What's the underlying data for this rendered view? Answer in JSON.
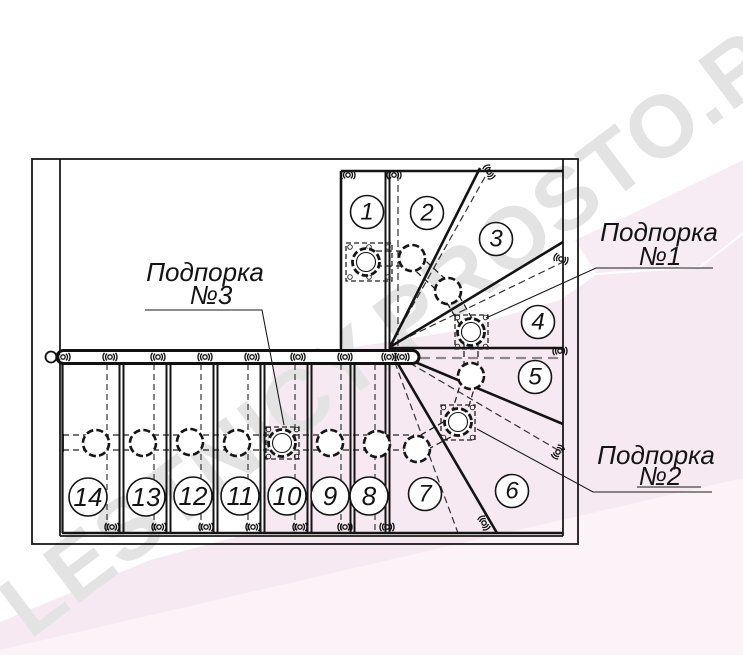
{
  "watermark": {
    "text": "LESTNICY.PROSTO.RU"
  },
  "supports": [
    {
      "title": "Подпорка",
      "number": "№1"
    },
    {
      "title": "Подпорка",
      "number": "№2"
    },
    {
      "title": "Подпорка",
      "number": "№3"
    }
  ],
  "steps": [
    "1",
    "2",
    "3",
    "4",
    "5",
    "6",
    "7",
    "8",
    "9",
    "10",
    "11",
    "12",
    "13",
    "14"
  ],
  "colors": {
    "line": "#1a1a1a",
    "pink_band": "#f7e9f2",
    "pink_band_light": "#fbf3f8",
    "pink_band_soft": "#f8ecf4",
    "watermark_text": "#e4e3e4"
  }
}
